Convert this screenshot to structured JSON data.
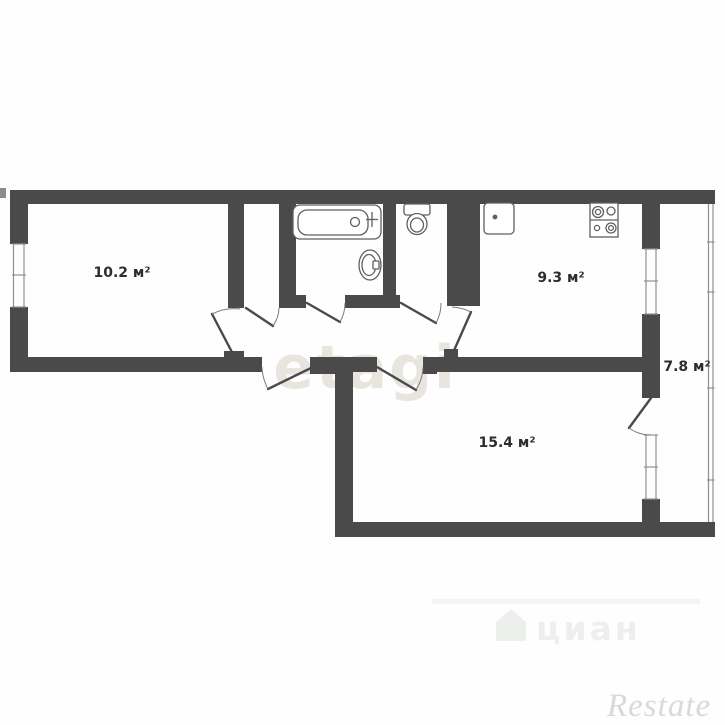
{
  "floor_plan": {
    "wall_color": "#4a4a4a",
    "window_line_color": "#8f8f8f",
    "fixture_outline_color": "#5f5f5f",
    "door_arc_color": "#7a7a7a",
    "label_color": "#2d2d2d",
    "rooms": [
      {
        "id": "living-room",
        "area_label": "10.2 м²"
      },
      {
        "id": "kitchen",
        "area_label": "9.3 м²"
      },
      {
        "id": "balcony",
        "area_label": "7.8 м²"
      },
      {
        "id": "bedroom",
        "area_label": "15.4 м²"
      }
    ],
    "fixtures": [
      "bathtub",
      "bathroom-sink",
      "toilet",
      "kitchen-sink",
      "stove"
    ]
  },
  "watermarks": {
    "center": "etagi",
    "portal": "циан",
    "agency": "Restate"
  }
}
